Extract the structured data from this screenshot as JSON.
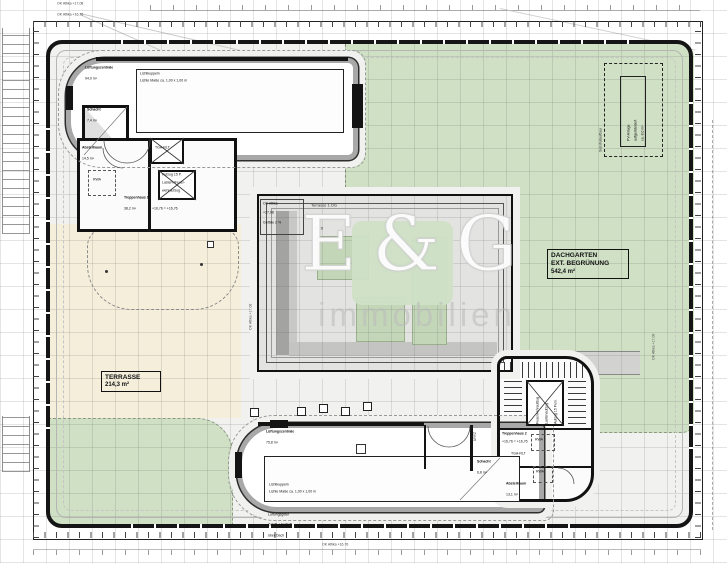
{
  "watermark": {
    "brand": "E&G",
    "subtitle": "Immobilien"
  },
  "dims": {
    "ok_attika_1708": "OK Attika +17,08",
    "ok_attika_1676": "OK Attika +16,76"
  },
  "dachgarten": {
    "l1": "DACHGARTEN",
    "l2": "EXT. BEGRÜNUNG",
    "l3": "542,4 m²"
  },
  "terrasse": {
    "l1": "TERRASSE",
    "l2": "214,3 m²"
  },
  "north": {
    "hall_name": "Lüftungszentrale",
    "hall_area": "94,0 m²",
    "skylight_l1": "Lichtkuppeln",
    "skylight_l2": "Lichte Maße ca. 1,00 x 1,00 m",
    "schacht_name": "Schacht",
    "schacht_area": "7,4 m²",
    "abstell_name": "Abstellraum",
    "abstell_area": "14,5 m²",
    "tga": "TGA-RLT",
    "stair_name": "Treppenhaus 1",
    "stair_area": "38,2 m²",
    "level": "+16,76 = +16,76",
    "lift_l1": "Aufzug 15 P.",
    "lift_l2": "Lasten-/Feuer-",
    "lift_l3": "wehraufzug",
    "rwa": "RWA"
  },
  "south": {
    "hall_name": "Lüftungszentrale",
    "hall_area": "75,8 m²",
    "skylight_l1": "Lichtkuppeln",
    "skylight_l2": "Lichte Maße ca. 1,00 x 1,00 m",
    "vent_l1": "Lüftungsgitter",
    "vent_l2": "Zuluft- / Fortluft",
    "vent_l3": "über Dach",
    "schacht_name": "Schacht",
    "schacht_area": "6,8 m²",
    "abstell_name": "Abstellraum",
    "abstell_area": "13,1 m²",
    "tga": "TGA-RLT",
    "stair_name": "Treppenhaus 2",
    "level": "+16,76 = +16,76",
    "lift_l1": "Aufzug 15 Pers.",
    "lift_l2": "Lastenaufzug",
    "lift_l3": "Feuerwehraufzug",
    "rwa": "RWA",
    "door_note": "Zuluft"
  },
  "courtyard": {
    "terrace_og": "Terrasse 1.OG",
    "marker_l1": "OK Attika",
    "marker_l2": "+17,08",
    "marker_l3": "Gefälle 2 %",
    "level": "+4,76",
    "dim": "OK Attika +17,08"
  },
  "pv": {
    "l1": "PV-Anlage",
    "l2": "aufgeständert",
    "l3": "ca. 8,0 m²",
    "side": "Substrataufbau"
  },
  "colors": {
    "green": "#cfe0c5",
    "beige": "#f4eedb",
    "wall": "#141414",
    "logo_green": "#cfe0c6"
  }
}
